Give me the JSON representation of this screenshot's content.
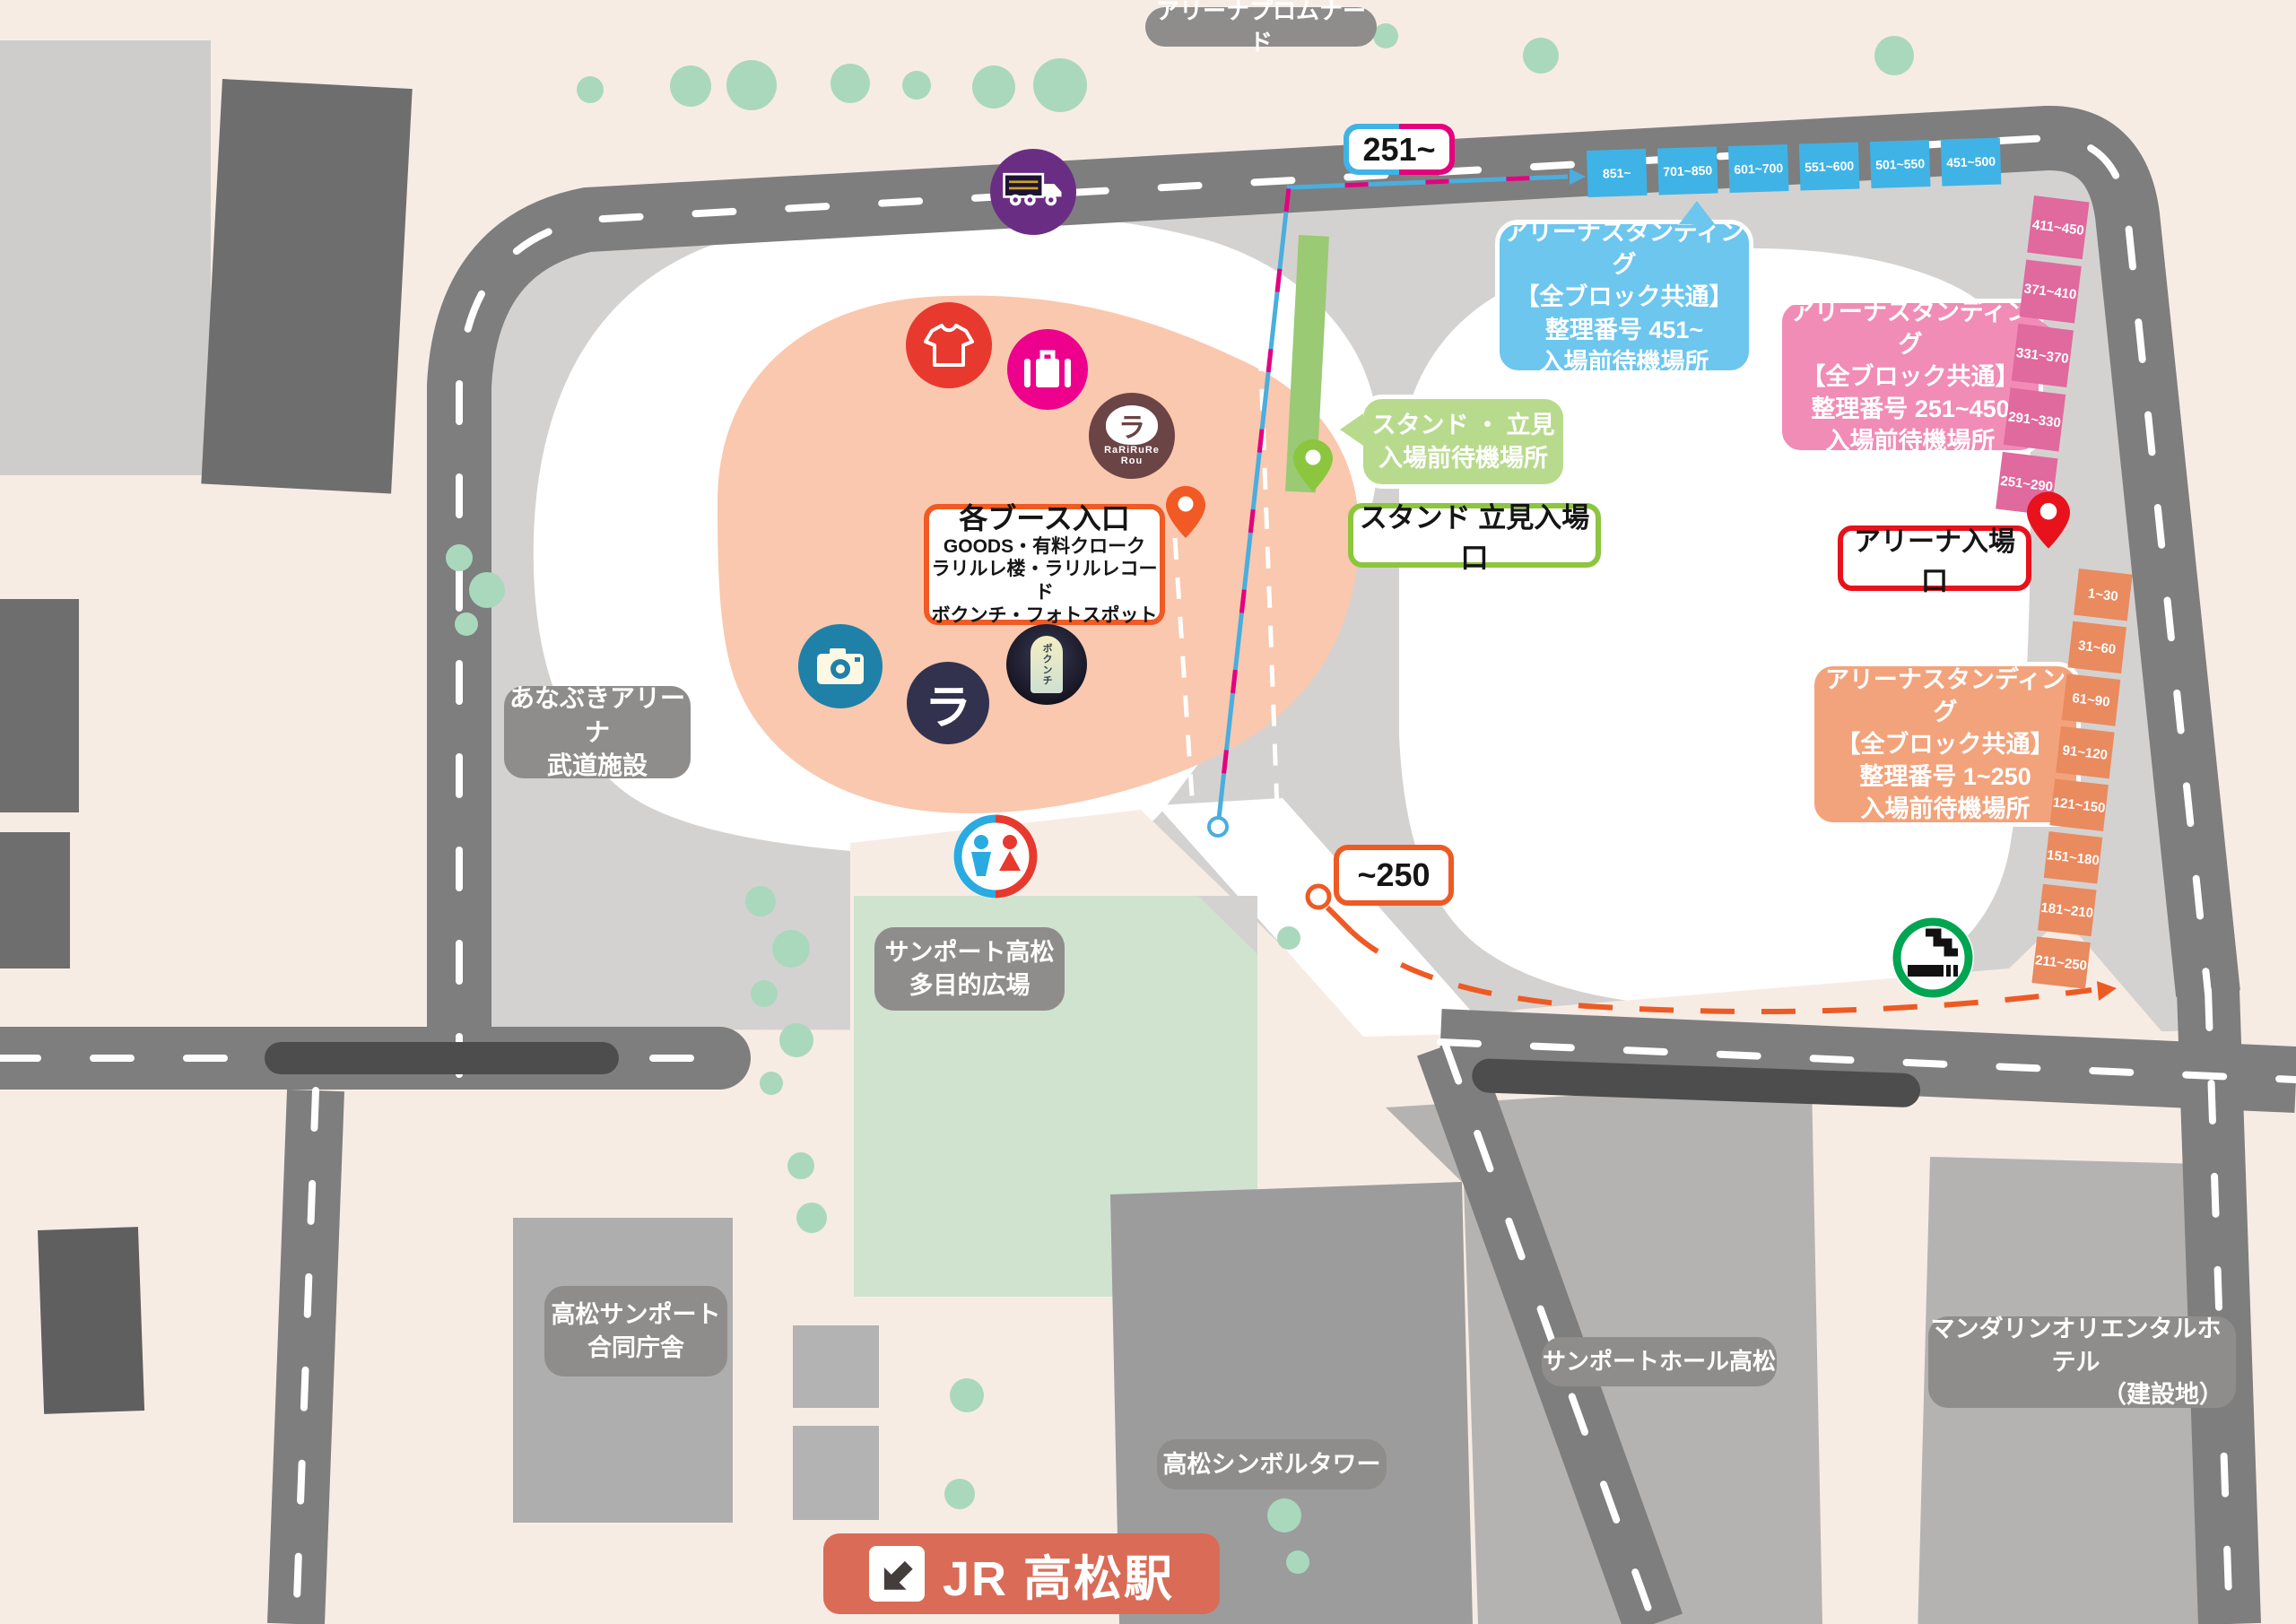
{
  "labels": {
    "promenade": "アリーナプロムナード",
    "arena": {
      "line1": "あなぶきアリーナ",
      "line2": "武道施設"
    },
    "plaza": {
      "line1": "サンポート高松",
      "line2": "多目的広場"
    },
    "godochosha": {
      "line1": "高松サンポート",
      "line2": "合同庁舎"
    },
    "symbol_tower": "高松シンボルタワー",
    "sunport_hall": "サンポートホール高松",
    "mandarin": {
      "line1": "マンダリンオリエンタルホテル",
      "line2": "（建設地）"
    },
    "station": "JR 高松駅"
  },
  "route_badges": {
    "blue_pink": "251~",
    "orange": "~250"
  },
  "callouts": {
    "blue": {
      "line1": "アリーナスタンディング",
      "line2": "【全ブロック共通】",
      "line3": "整理番号 451~",
      "line4": "入場前待機場所"
    },
    "pink": {
      "line1": "アリーナスタンディング",
      "line2": "【全ブロック共通】",
      "line3": "整理番号 251~450",
      "line4": "入場前待機場所"
    },
    "orange": {
      "line1": "アリーナスタンディング",
      "line2": "【全ブロック共通】",
      "line3": "整理番号 1~250",
      "line4": "入場前待機場所"
    },
    "green": {
      "line1": "スタンド ・ 立見",
      "line2": "入場前待機場所"
    }
  },
  "entrances": {
    "booth": {
      "title": "各ブース入口",
      "line1": "GOODS・有料クローク",
      "line2": "ラリルレ楼・ラリルレコード",
      "line3": "ボクンチ・フォトスポット"
    },
    "stand": "スタンド 立見入場口",
    "arena": "アリーナ入場口"
  },
  "blocks": {
    "blue": [
      "851~",
      "701~850",
      "601~700",
      "551~600",
      "501~550",
      "451~500"
    ],
    "pink": [
      "411~450",
      "371~410",
      "331~370",
      "291~330",
      "251~290"
    ],
    "orange": [
      "1~30",
      "31~60",
      "61~90",
      "91~120",
      "121~150",
      "151~180",
      "181~210",
      "211~250"
    ]
  },
  "logos": {
    "rarirure_glyph": "ラ",
    "rarirure_name": "RaRiRuRe",
    "rarirure_name2": "Rou",
    "record_glyph": "ラ",
    "bokunchi": "ボクンチ"
  },
  "colors": {
    "background": "#f7ece4",
    "road": "#7e7e7e",
    "concourse": "#d4d2d0",
    "booth_area": "#f9c8ae",
    "plaza_green": "#cfe3cf",
    "tree": "#a9d8bd",
    "block_blue": "#3fb3e5",
    "block_pink": "#e0699e",
    "block_orange": "#e98a5f",
    "callout_blue": "#6cc6ee",
    "callout_pink": "#f08cb5",
    "callout_orange": "#f2a37b",
    "callout_green": "#b8da8d",
    "route_blue": "#4aaede",
    "route_magenta": "#e6007e",
    "route_orange": "#ee5a24",
    "border_booth": "#f15a24",
    "border_stand": "#8cc63e",
    "border_arena": "#e8121c",
    "station_badge": "#d96b57",
    "label_gray": "#8f8d8b"
  }
}
